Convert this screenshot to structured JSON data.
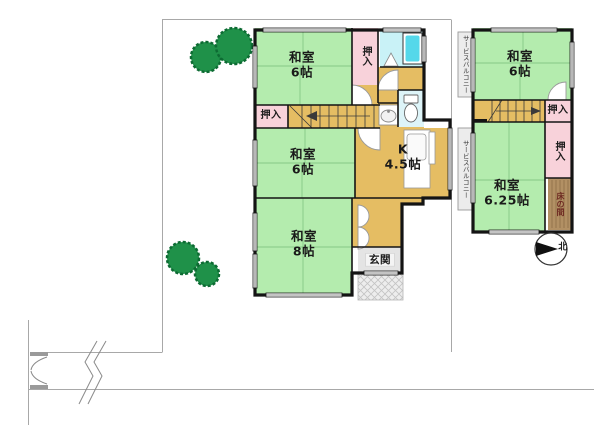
{
  "plan_title": "floor-plan",
  "floor1": {
    "room_washitsu6_top": "和室\n6帖",
    "room_washitsu6_mid": "和室\n6帖",
    "room_washitsu8": "和室\n8帖",
    "kitchen": "K\n4.5帖",
    "entrance": "玄関",
    "closet_upper": "押入",
    "closet_stairs": "押入"
  },
  "floor2": {
    "room_washitsu6": "和室\n6帖",
    "room_washitsu625": "和室\n6.25帖",
    "closet_by_stairs": "押入",
    "closet_side": "押入",
    "tokonoma": "床の間",
    "balcony_top": "サービスバルコニー",
    "balcony_bottom": "サービスバルコニー"
  },
  "compass": {
    "north": "北"
  },
  "colors": {
    "room_green": "#b4ecae",
    "tatami_line": "#86c886",
    "closet_pink": "#f8d2da",
    "hall_tan": "#e5bd63",
    "bath_cyan": "#c9f2f7",
    "tub_cyan": "#55d8ea",
    "entry_gray": "#e4e4e4",
    "tokonoma_brown": "#b29064",
    "tree_green": "#1f9149",
    "wall_black": "#141414",
    "boundary_gray": "#a8a8a8"
  }
}
